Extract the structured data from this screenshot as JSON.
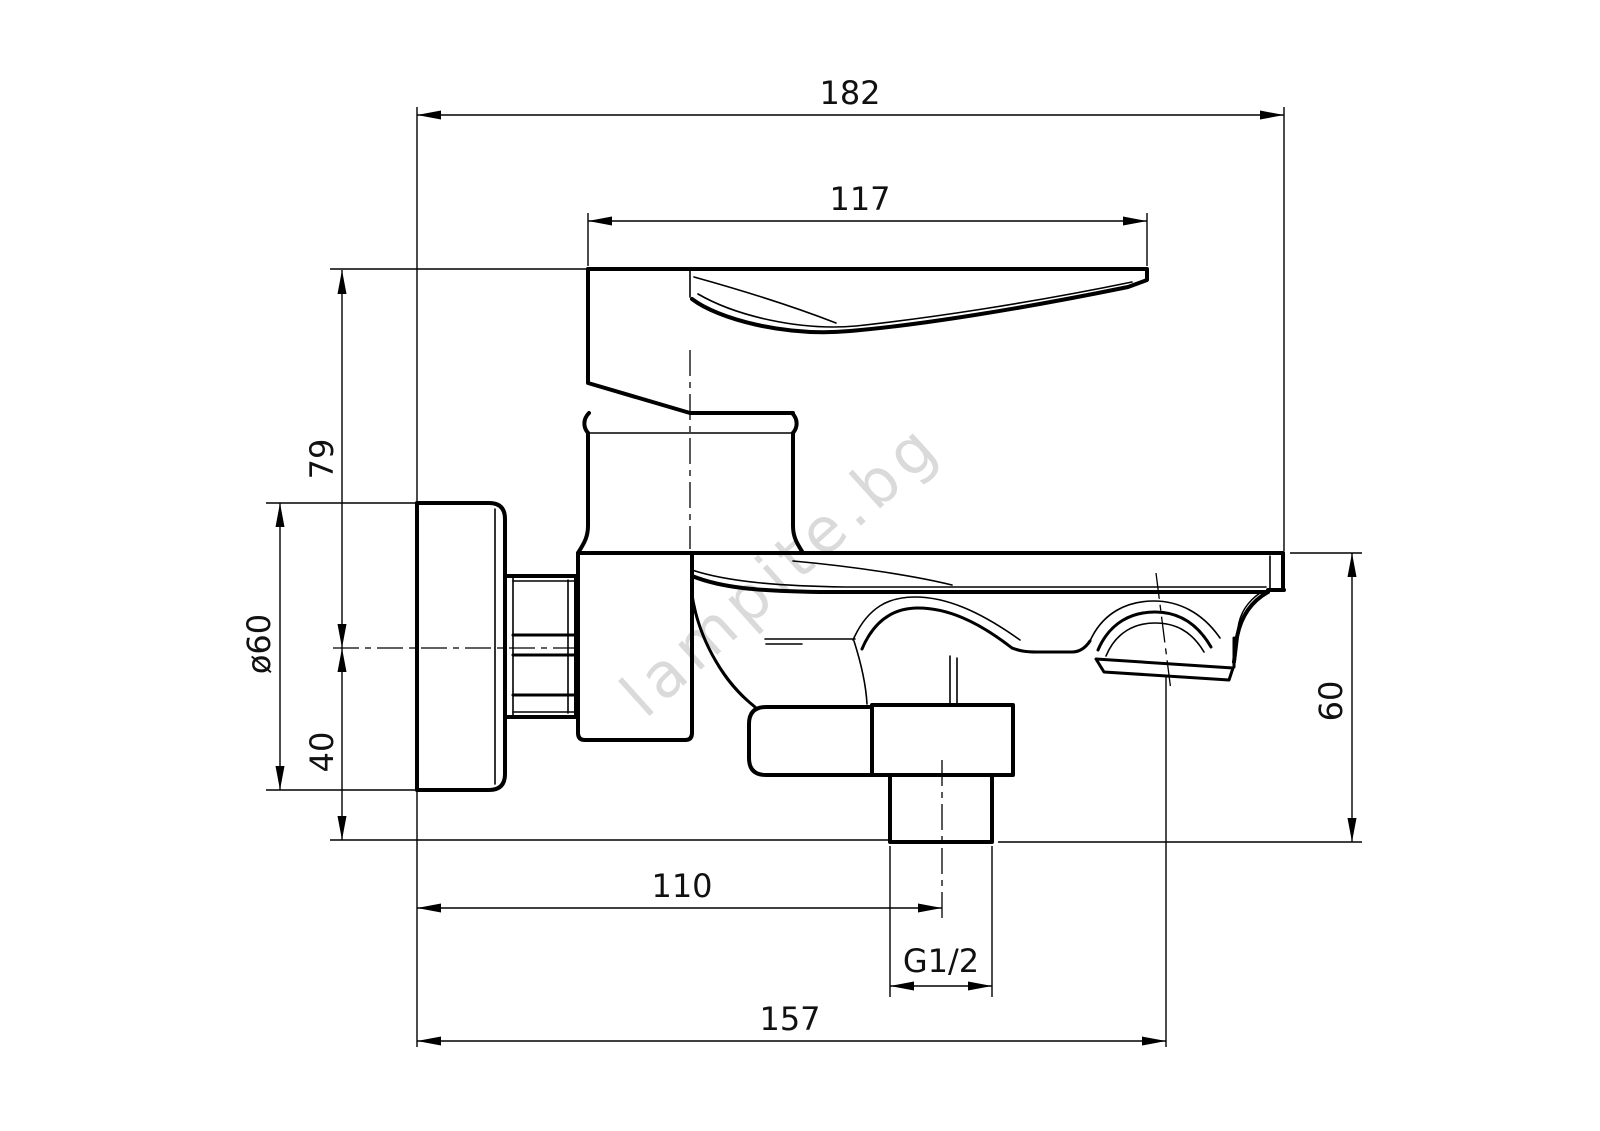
{
  "drawing": {
    "watermark": "lampite.bg",
    "colors": {
      "line": "#000000",
      "background": "#ffffff",
      "watermark": "#d7d7d7"
    },
    "dimensions": {
      "overall_width": "182",
      "lever_length": "117",
      "height_above_axis": "79",
      "flange_diameter": "ø60",
      "axis_to_flange_bottom": "40",
      "spout_height": "60",
      "axis_to_shower_outlet": "110",
      "shower_outlet_thread": "G1/2",
      "wall_to_aerator": "157"
    }
  }
}
